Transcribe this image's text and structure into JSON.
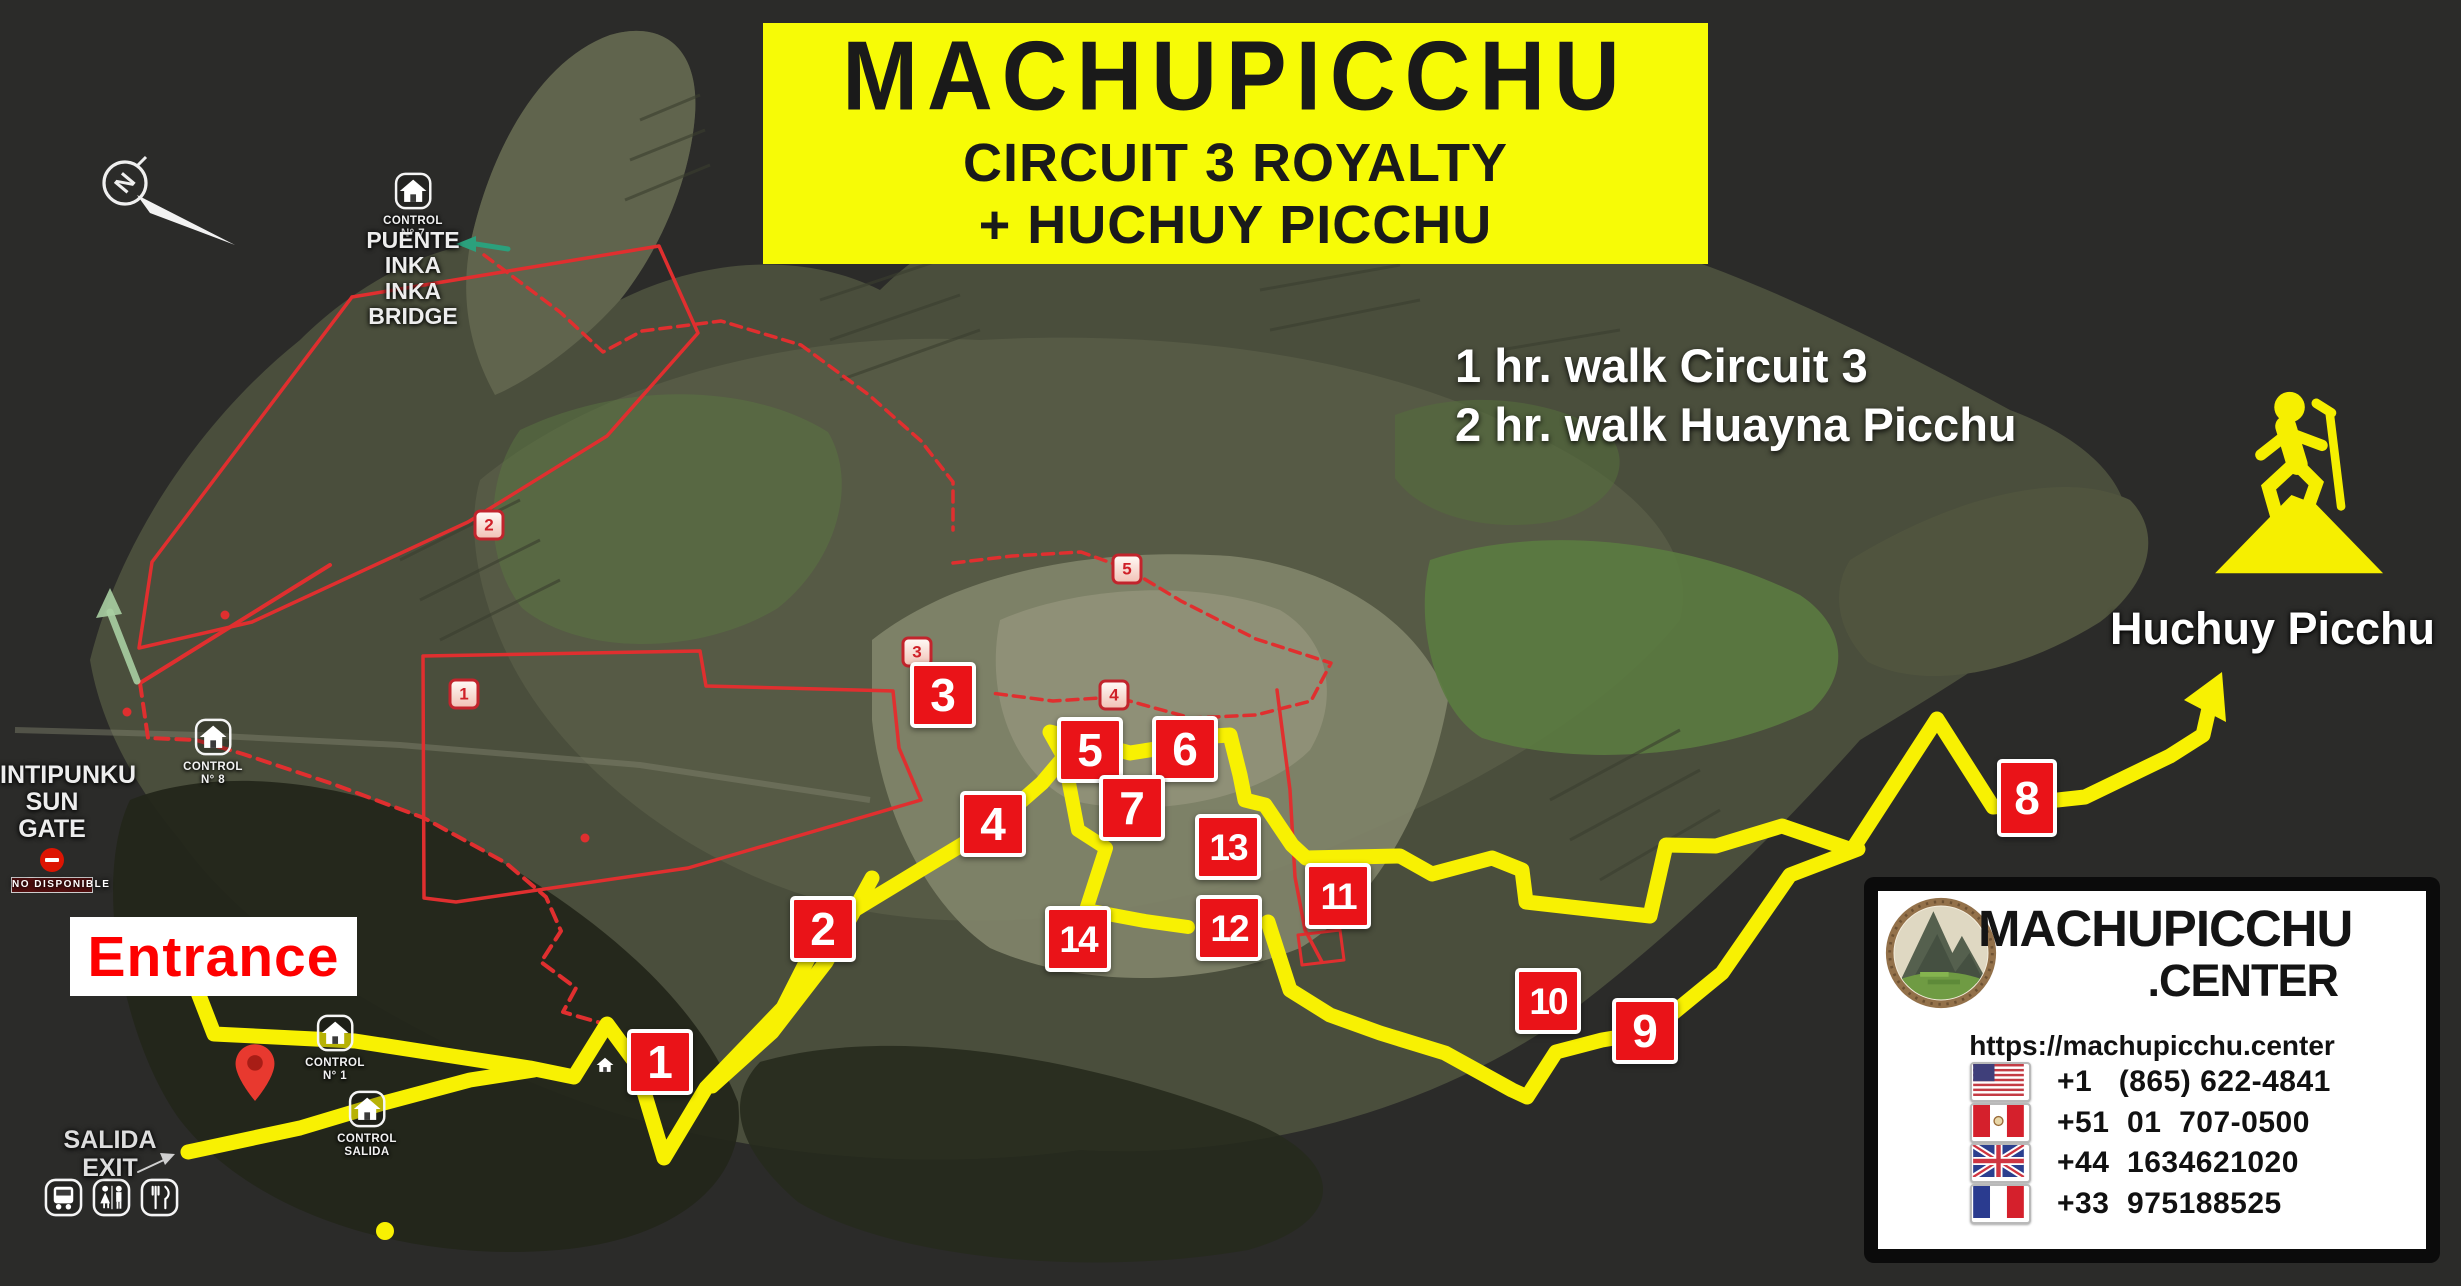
{
  "colors": {
    "map_bg": "#2b2b29",
    "banner_yellow": "#f7fb06",
    "route_yellow": "#f8f102",
    "marker_red": "#ea1318",
    "badge_red": "#c5242c",
    "red_route": "#e02f2f",
    "green_arrow": "#2ba07c",
    "pale_green_arrow": "#a9cfa2",
    "entrance_red": "#fe0000",
    "text_white": "#f2f2f2"
  },
  "banner": {
    "title": "MACHUPICCHU",
    "subtitle1": "CIRCUIT 3 ROYALTY",
    "subtitle2": "+ HUCHUY PICCHU"
  },
  "walk_info": {
    "line1": "1 hr. walk Circuit 3",
    "line2": "2 hr. walk Huayna Picchu"
  },
  "huchuy": {
    "label": "Huchuy Picchu"
  },
  "entrance": {
    "label": "Entrance"
  },
  "intipunku": {
    "line1": "INTIPUNKU",
    "line2": "SUN GATE",
    "status": "NO DISPONIBLE"
  },
  "salida": {
    "line1": "SALIDA",
    "line2": "EXIT"
  },
  "puente_inka": {
    "line1": "PUENTE INKA",
    "line2": "INKA BRIDGE"
  },
  "compass": {
    "label": "N"
  },
  "controls": [
    {
      "id": "control-7",
      "label": "CONTROL",
      "sublabel": "N° 7",
      "x": 413,
      "y": 191
    },
    {
      "id": "control-8",
      "label": "CONTROL",
      "sublabel": "N° 8",
      "x": 213,
      "y": 737
    },
    {
      "id": "control-1",
      "label": "CONTROL",
      "sublabel": "N° 1",
      "x": 335,
      "y": 1033
    },
    {
      "id": "control-salida",
      "label": "CONTROL",
      "sublabel": "SALIDA",
      "x": 367,
      "y": 1109
    },
    {
      "id": "house",
      "label": "",
      "sublabel": "",
      "x": 605,
      "y": 1072
    }
  ],
  "markers": [
    {
      "n": 1,
      "x": 660,
      "y": 1062
    },
    {
      "n": 2,
      "x": 823,
      "y": 929
    },
    {
      "n": 3,
      "x": 943,
      "y": 695
    },
    {
      "n": 4,
      "x": 993,
      "y": 824
    },
    {
      "n": 5,
      "x": 1090,
      "y": 750
    },
    {
      "n": 6,
      "x": 1185,
      "y": 749
    },
    {
      "n": 7,
      "x": 1132,
      "y": 808
    },
    {
      "n": 8,
      "x": 2027,
      "y": 798,
      "tall": true
    },
    {
      "n": 9,
      "x": 1645,
      "y": 1031
    },
    {
      "n": 10,
      "x": 1548,
      "y": 1001
    },
    {
      "n": 11,
      "x": 1338,
      "y": 896
    },
    {
      "n": 12,
      "x": 1229,
      "y": 928
    },
    {
      "n": 13,
      "x": 1228,
      "y": 847
    },
    {
      "n": 14,
      "x": 1078,
      "y": 939
    }
  ],
  "waypoint_badges": [
    {
      "n": 1,
      "x": 464,
      "y": 694
    },
    {
      "n": 2,
      "x": 489,
      "y": 525
    },
    {
      "n": 3,
      "x": 917,
      "y": 652
    },
    {
      "n": 4,
      "x": 1114,
      "y": 695
    },
    {
      "n": 5,
      "x": 1127,
      "y": 569
    }
  ],
  "facilities": [
    {
      "id": "bus-icon"
    },
    {
      "id": "restroom-icon"
    },
    {
      "id": "restaurant-icon"
    }
  ],
  "contact": {
    "brand_top": "MACHUPICCHU",
    "brand_bottom": ".CENTER",
    "url": "https://machupicchu.center",
    "phones": [
      {
        "flag": "us",
        "number": "+1   (865) 622-4841"
      },
      {
        "flag": "pe",
        "number": "+51  01  707-0500"
      },
      {
        "flag": "gb",
        "number": "+44  1634621020"
      },
      {
        "flag": "fr",
        "number": "+33  975188525"
      }
    ]
  },
  "map_dot": {
    "x": 385,
    "y": 1231
  },
  "routes": {
    "yellow_main": [
      [
        197,
        990
      ],
      [
        214,
        1034
      ],
      [
        355,
        1041
      ],
      [
        452,
        1056
      ],
      [
        530,
        1068
      ],
      [
        574,
        1077
      ],
      [
        607,
        1024
      ],
      [
        635,
        1062
      ],
      [
        664,
        1158
      ],
      [
        706,
        1088
      ],
      [
        783,
        1008
      ],
      [
        823,
        929
      ],
      [
        920,
        870
      ],
      [
        993,
        826
      ],
      [
        1042,
        783
      ],
      [
        1064,
        757
      ],
      [
        1050,
        732
      ],
      [
        1092,
        743
      ],
      [
        1130,
        753
      ],
      [
        1162,
        748
      ],
      [
        1196,
        737
      ],
      [
        1230,
        735
      ],
      [
        1240,
        775
      ],
      [
        1245,
        800
      ],
      [
        1265,
        805
      ],
      [
        1292,
        845
      ],
      [
        1306,
        858
      ],
      [
        1400,
        856
      ],
      [
        1432,
        874
      ],
      [
        1492,
        858
      ],
      [
        1522,
        870
      ],
      [
        1526,
        902
      ],
      [
        1650,
        916
      ],
      [
        1666,
        845
      ],
      [
        1716,
        846
      ],
      [
        1782,
        826
      ],
      [
        1852,
        850
      ],
      [
        1937,
        719
      ],
      [
        1993,
        807
      ],
      [
        2085,
        797
      ],
      [
        2170,
        756
      ],
      [
        2203,
        735
      ],
      [
        2210,
        704
      ]
    ],
    "yellow_arrowhead": [
      [
        2222,
        672
      ],
      [
        2184,
        700
      ],
      [
        2226,
        722
      ]
    ],
    "yellow_exit_diag": [
      [
        872,
        878
      ],
      [
        826,
        962
      ],
      [
        772,
        1032
      ],
      [
        712,
        1086
      ]
    ],
    "yellow_exit_spur": [
      [
        534,
        1070
      ],
      [
        470,
        1080
      ],
      [
        380,
        1104
      ],
      [
        300,
        1128
      ],
      [
        188,
        1152
      ]
    ],
    "yellow_inner": [
      [
        1064,
        757
      ],
      [
        1078,
        830
      ],
      [
        1106,
        848
      ],
      [
        1086,
        910
      ],
      [
        1145,
        921
      ],
      [
        1188,
        927
      ]
    ],
    "yellow_lower": [
      [
        1268,
        922
      ],
      [
        1290,
        990
      ],
      [
        1330,
        1015
      ],
      [
        1380,
        1033
      ],
      [
        1445,
        1053
      ],
      [
        1512,
        1090
      ],
      [
        1527,
        1097
      ],
      [
        1556,
        1052
      ],
      [
        1602,
        1040
      ],
      [
        1650,
        1032
      ],
      [
        1722,
        973
      ],
      [
        1790,
        875
      ],
      [
        1858,
        849
      ]
    ],
    "red_connector": [
      [
        330,
        565
      ],
      [
        140,
        683
      ]
    ],
    "red_road_dashed": [
      [
        140,
        683
      ],
      [
        148,
        738
      ],
      [
        196,
        740
      ],
      [
        243,
        754
      ],
      [
        333,
        784
      ],
      [
        424,
        818
      ],
      [
        506,
        863
      ],
      [
        546,
        897
      ],
      [
        561,
        931
      ],
      [
        541,
        962
      ],
      [
        576,
        988
      ],
      [
        563,
        1012
      ],
      [
        601,
        1023
      ]
    ],
    "red_loop_upper": [
      [
        352,
        297
      ],
      [
        659,
        246
      ],
      [
        698,
        333
      ],
      [
        607,
        436
      ],
      [
        468,
        522
      ],
      [
        252,
        622
      ],
      [
        139,
        648
      ],
      [
        152,
        562
      ],
      [
        352,
        297
      ]
    ],
    "red_area_lower": [
      [
        423,
        656
      ],
      [
        700,
        651
      ],
      [
        706,
        686
      ],
      [
        893,
        691
      ],
      [
        899,
        748
      ],
      [
        921,
        800
      ],
      [
        688,
        868
      ],
      [
        456,
        902
      ],
      [
        424,
        898
      ],
      [
        423,
        656
      ]
    ],
    "red_dashed_top": [
      [
        484,
        255
      ],
      [
        560,
        312
      ],
      [
        603,
        352
      ],
      [
        642,
        331
      ],
      [
        721,
        321
      ],
      [
        801,
        345
      ],
      [
        869,
        395
      ],
      [
        921,
        441
      ],
      [
        953,
        482
      ],
      [
        953,
        530
      ]
    ],
    "red_dashed_ruins": [
      [
        953,
        563
      ],
      [
        1012,
        556
      ],
      [
        1081,
        552
      ],
      [
        1128,
        569
      ],
      [
        1181,
        601
      ],
      [
        1256,
        639
      ],
      [
        1331,
        663
      ],
      [
        1311,
        701
      ],
      [
        1256,
        715
      ],
      [
        1191,
        718
      ],
      [
        1115,
        697
      ],
      [
        1053,
        701
      ],
      [
        991,
        693
      ]
    ],
    "red_solid_right": [
      [
        1277,
        690
      ],
      [
        1290,
        790
      ],
      [
        1295,
        877
      ],
      [
        1305,
        930
      ],
      [
        1322,
        962
      ]
    ],
    "red_rect": [
      [
        1298,
        935
      ],
      [
        1340,
        930
      ],
      [
        1344,
        960
      ],
      [
        1302,
        965
      ],
      [
        1298,
        935
      ]
    ],
    "green_arrow_bridge_line": [
      [
        508,
        249
      ],
      [
        476,
        244
      ]
    ],
    "green_arrow_bridge_head": [
      [
        476,
        236
      ],
      [
        456,
        244
      ],
      [
        476,
        252
      ]
    ],
    "pale_arrow_line": [
      [
        137,
        681
      ],
      [
        110,
        612
      ]
    ],
    "pale_arrow_head": [
      [
        96,
        618
      ],
      [
        110,
        588
      ],
      [
        122,
        614
      ]
    ],
    "salida_arrow_line": [
      [
        138,
        1172
      ],
      [
        166,
        1159
      ]
    ],
    "salida_arrow_head": [
      [
        175,
        1154
      ],
      [
        160,
        1153
      ],
      [
        165,
        1165
      ]
    ],
    "red_dots": [
      [
        225,
        615
      ],
      [
        127,
        712
      ],
      [
        585,
        838
      ]
    ]
  }
}
